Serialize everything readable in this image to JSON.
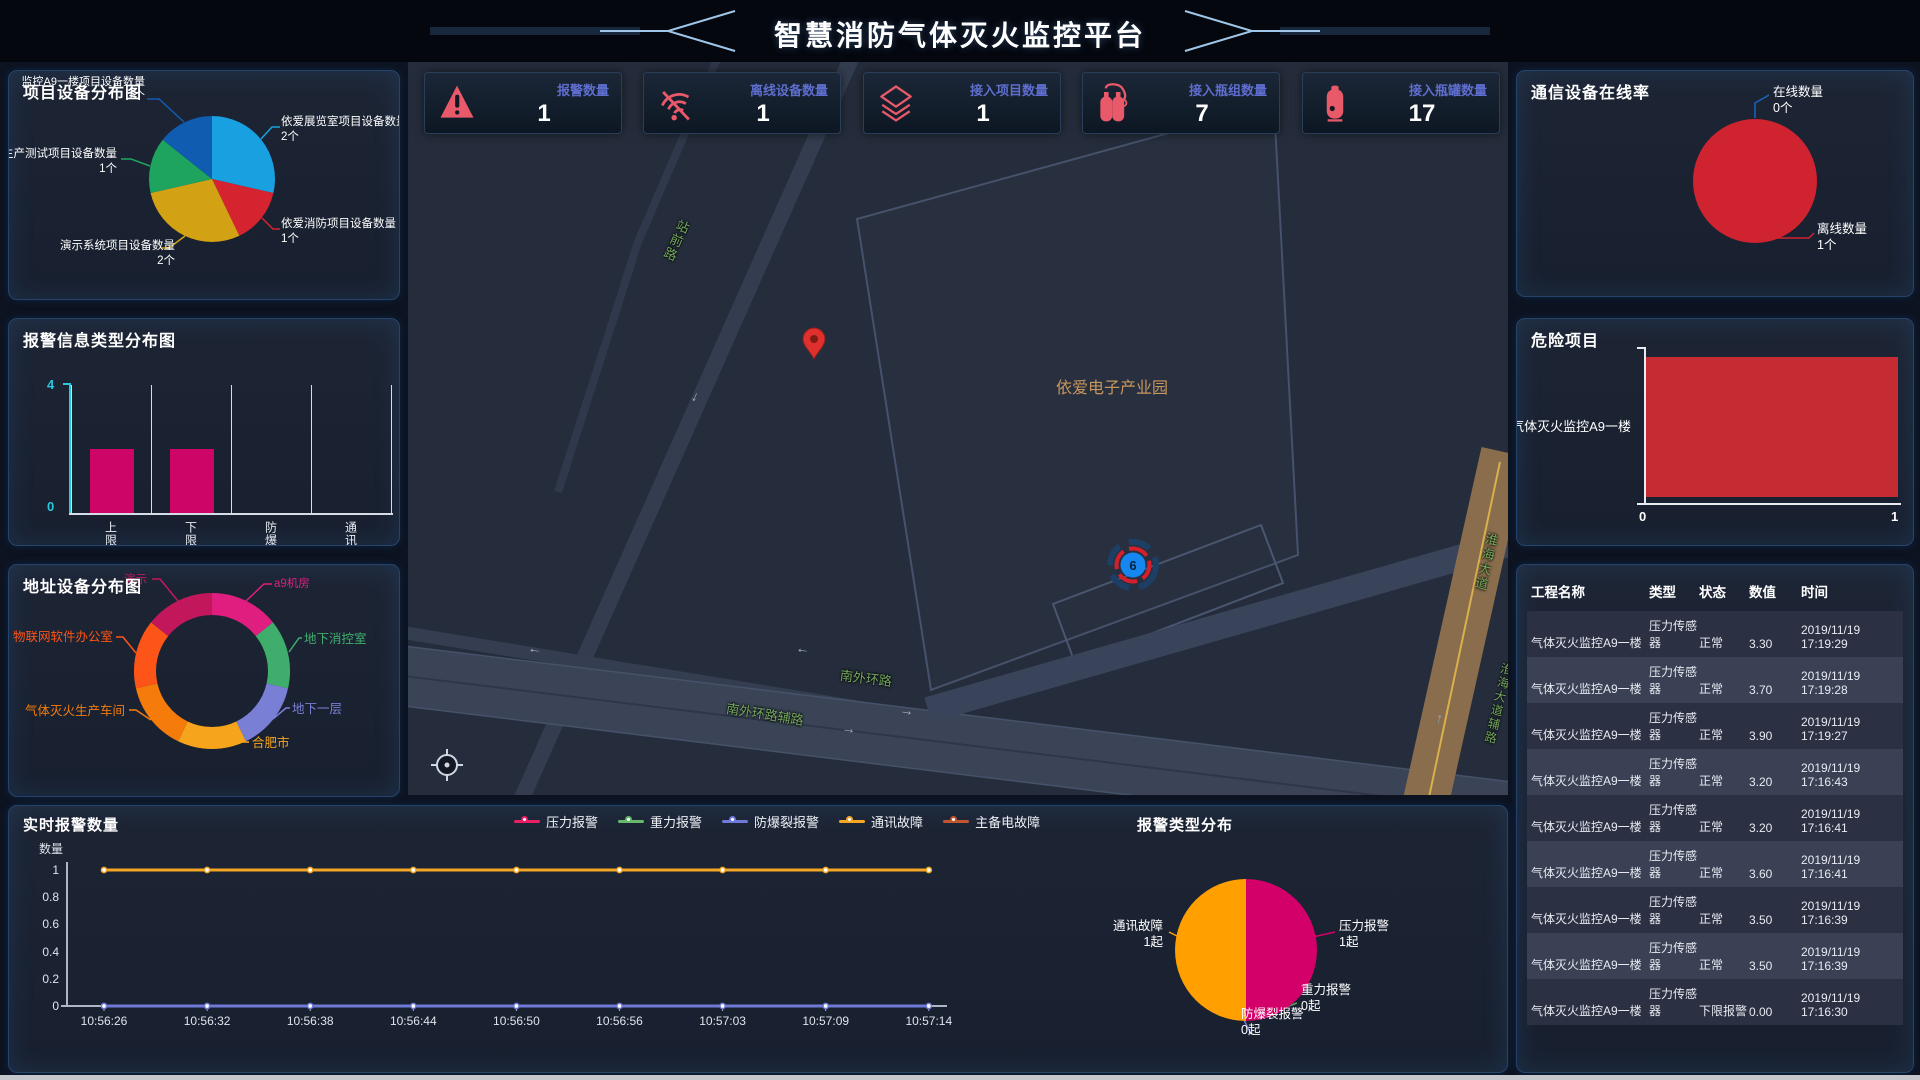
{
  "header": {
    "title": "智慧消防气体灭火监控平台"
  },
  "stats": [
    {
      "icon": "alarm-warning-icon",
      "label": "报警数量",
      "value": "1"
    },
    {
      "icon": "wifi-off-icon",
      "label": "离线设备数量",
      "value": "1"
    },
    {
      "icon": "layers-icon",
      "label": "接入项目数量",
      "value": "1"
    },
    {
      "icon": "cylinder-group-icon",
      "label": "接入瓶组数量",
      "value": "7"
    },
    {
      "icon": "tank-icon",
      "label": "接入瓶罐数量",
      "value": "17"
    }
  ],
  "project_pie": {
    "title": "项目设备分布图",
    "slices": [
      {
        "label": "依爱展览室项目设备数量",
        "count_text": "2个",
        "value": 2,
        "color": "#18a0e0"
      },
      {
        "label": "依爱消防项目设备数量",
        "count_text": "1个",
        "value": 1,
        "color": "#d5232f"
      },
      {
        "label": "演示系统项目设备数量",
        "count_text": "2个",
        "value": 2,
        "color": "#d2a214"
      },
      {
        "label": "生产测试项目设备数量",
        "count_text": "1个",
        "value": 1,
        "color": "#1ea45f"
      },
      {
        "label": "监控A9一楼项目设备数量",
        "count_text": "1个",
        "value": 1,
        "color": "#0f5cb0"
      }
    ]
  },
  "alarm_type_bar": {
    "title": "报警信息类型分布图",
    "categories": [
      "上限报警",
      "下限报警",
      "防爆裂",
      "通讯故障"
    ],
    "values": [
      2,
      2,
      0,
      0
    ],
    "ymax": 4,
    "ymax_label": "4",
    "ymin_label": "0",
    "bar_color": "#cc0566"
  },
  "address_donut": {
    "title": "地址设备分布图",
    "slices": [
      {
        "label": "a9机房",
        "value": 1,
        "color": "#df1e7f"
      },
      {
        "label": "地下消控室",
        "value": 1,
        "color": "#3fae6c"
      },
      {
        "label": "地下一层",
        "value": 1,
        "color": "#7a7fd6"
      },
      {
        "label": "合肥市",
        "value": 1,
        "color": "#f7a41d"
      },
      {
        "label": "气体灭火生产车间",
        "value": 1,
        "color": "#f57c0b"
      },
      {
        "label": "物联网软件办公室",
        "value": 1,
        "color": "#fd5517"
      },
      {
        "label": "演示",
        "value": 1,
        "color": "#c2185b"
      }
    ]
  },
  "online_pie": {
    "title": "通信设备在线率",
    "slices": [
      {
        "label": "在线数量",
        "count_text": "0个",
        "value": 0,
        "color": "#1565c0"
      },
      {
        "label": "离线数量",
        "count_text": "1个",
        "value": 1,
        "color": "#d02330"
      }
    ]
  },
  "danger_bar": {
    "title": "危险项目",
    "categories": [
      "气体灭火监控A9一楼"
    ],
    "values": [
      1
    ],
    "xmax": 1,
    "x_ticks": [
      "0",
      "1"
    ],
    "bar_color": "#c52b33"
  },
  "device_table": {
    "columns": [
      "工程名称",
      "类型",
      "状态",
      "数值",
      "时间"
    ],
    "rows": [
      [
        "气体灭火监控A9一楼",
        "压力传感器",
        "正常",
        "3.30",
        "2019/11/19 17:19:29"
      ],
      [
        "气体灭火监控A9一楼",
        "压力传感器",
        "正常",
        "3.70",
        "2019/11/19 17:19:28"
      ],
      [
        "气体灭火监控A9一楼",
        "压力传感器",
        "正常",
        "3.90",
        "2019/11/19 17:19:27"
      ],
      [
        "气体灭火监控A9一楼",
        "压力传感器",
        "正常",
        "3.20",
        "2019/11/19 17:16:43"
      ],
      [
        "气体灭火监控A9一楼",
        "压力传感器",
        "正常",
        "3.20",
        "2019/11/19 17:16:41"
      ],
      [
        "气体灭火监控A9一楼",
        "压力传感器",
        "正常",
        "3.60",
        "2019/11/19 17:16:41"
      ],
      [
        "气体灭火监控A9一楼",
        "压力传感器",
        "正常",
        "3.50",
        "2019/11/19 17:16:39"
      ],
      [
        "气体灭火监控A9一楼",
        "压力传感器",
        "正常",
        "3.50",
        "2019/11/19 17:16:39"
      ],
      [
        "气体灭火监控A9一楼",
        "压力传感器",
        "下限报警",
        "0.00",
        "2019/11/19 17:16:30"
      ]
    ]
  },
  "realtime_line": {
    "title": "实时报警数量",
    "ylabel": "数量",
    "y_ticks": [
      "1",
      "0.8",
      "0.6",
      "0.4",
      "0.2",
      "0"
    ],
    "x": [
      "10:56:26",
      "10:56:32",
      "10:56:38",
      "10:56:44",
      "10:56:50",
      "10:56:56",
      "10:57:03",
      "10:57:09",
      "10:57:14"
    ],
    "series": [
      {
        "name": "压力报警",
        "color": "#e91e63",
        "values": []
      },
      {
        "name": "重力报警",
        "color": "#66bb6a",
        "values": []
      },
      {
        "name": "防爆裂报警",
        "color": "#6f79d8",
        "values": [
          0,
          0,
          0,
          0,
          0,
          0,
          0,
          0,
          0
        ]
      },
      {
        "name": "通讯故障",
        "color": "#f5a623",
        "values": [
          1,
          1,
          1,
          1,
          1,
          1,
          1,
          1,
          1
        ]
      },
      {
        "name": "主备电故障",
        "color": "#c0562f",
        "values": []
      }
    ]
  },
  "alarm_dist_pie": {
    "title": "报警类型分布",
    "slices": [
      {
        "label": "压力报警",
        "count_text": "1起",
        "value": 1,
        "color": "#d4006a"
      },
      {
        "label": "重力报警",
        "count_text": "0起",
        "value": 0,
        "color": "#4caf50"
      },
      {
        "label": "防爆裂报警",
        "count_text": "0起",
        "value": 0,
        "color": "#7a7fd6"
      },
      {
        "label": "通讯故障",
        "count_text": "1起",
        "value": 1,
        "color": "#ffa000"
      }
    ]
  },
  "map": {
    "park_label": "依爱电子产业园",
    "cluster_count": "6",
    "road_labels": {
      "south_ring": "南外环路",
      "south_ring_aux": "南外环路辅路",
      "station_rd_1": "站前路",
      "station_rd_2": "站前路",
      "avenue": "淮海大道",
      "avenue_aux": "淮海大道辅路"
    }
  }
}
